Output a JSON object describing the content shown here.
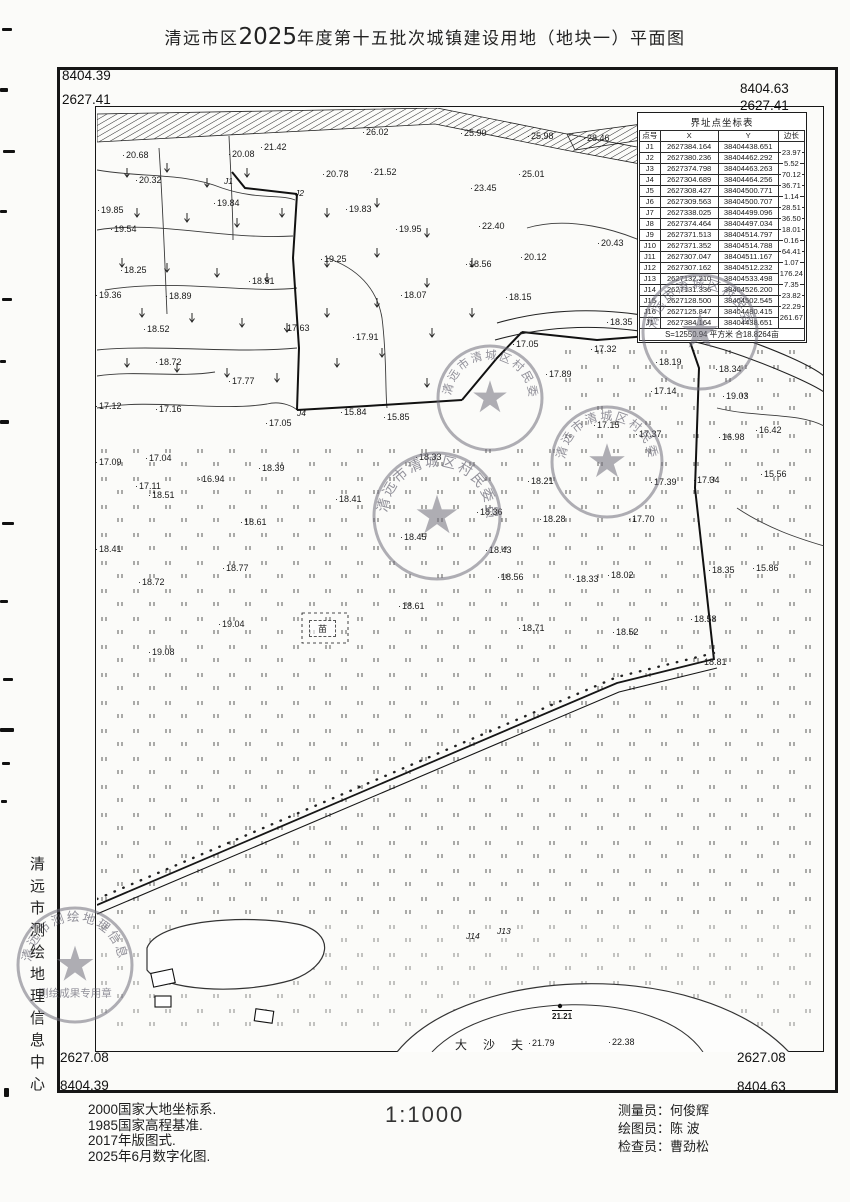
{
  "title": {
    "pre": "清远市区",
    "year": "2025",
    "post": "年度第十五批次城镇建设用地（地块一）平面图"
  },
  "frame": {
    "top_left_x": "8404.39",
    "top_left_y": "2627.41",
    "top_right_x": "8404.63",
    "top_right_y": "2627.41",
    "bottom_left_y": "2627.08",
    "bottom_left_x": "8404.39",
    "bottom_right_y": "2627.08",
    "bottom_right_x": "8404.63"
  },
  "coord_table": {
    "title": "界址点坐标表",
    "headers": [
      "点号",
      "X",
      "Y",
      "边长"
    ],
    "rows": [
      {
        "id": "J1",
        "x": "2627384.164",
        "y": "38404438.651",
        "d": ""
      },
      {
        "id": "J2",
        "x": "2627380.236",
        "y": "38404462.292",
        "d": "23.97"
      },
      {
        "id": "J3",
        "x": "2627374.798",
        "y": "38404463.263",
        "d": "5.52"
      },
      {
        "id": "J4",
        "x": "2627304.689",
        "y": "38404464.256",
        "d": "70.12"
      },
      {
        "id": "J5",
        "x": "2627308.427",
        "y": "38404500.771",
        "d": "36.71"
      },
      {
        "id": "J6",
        "x": "2627309.563",
        "y": "38404500.707",
        "d": "1.14"
      },
      {
        "id": "J7",
        "x": "2627338.025",
        "y": "38404499.096",
        "d": "28.51"
      },
      {
        "id": "J8",
        "x": "2627374.464",
        "y": "38404497.034",
        "d": "36.50"
      },
      {
        "id": "J9",
        "x": "2627371.513",
        "y": "38404514.797",
        "d": "18.01"
      },
      {
        "id": "J10",
        "x": "2627371.352",
        "y": "38404514.788",
        "d": "0.16"
      },
      {
        "id": "J11",
        "x": "2627307.047",
        "y": "38404511.167",
        "d": "64.41"
      },
      {
        "id": "J12",
        "x": "2627307.162",
        "y": "38404512.232",
        "d": "1.07"
      },
      {
        "id": "J13",
        "x": "2627132.210",
        "y": "38404533.498",
        "d": "176.24"
      },
      {
        "id": "J14",
        "x": "2627131.336",
        "y": "38404526.200",
        "d": "7.35"
      },
      {
        "id": "J15",
        "x": "2627128.500",
        "y": "38404502.545",
        "d": "23.82"
      },
      {
        "id": "J16",
        "x": "2627125.847",
        "y": "38404480.415",
        "d": "22.29"
      },
      {
        "id": "J1",
        "x": "2627384.164",
        "y": "38404438.651",
        "d": "261.67"
      }
    ],
    "summary": "S=12550.94 平方米 合18.8264亩"
  },
  "map": {
    "cement_label": "水泥",
    "dashafu_label": "大沙夫",
    "seedling_label": "苗",
    "control_point": {
      "x": 463,
      "y": 901,
      "label": "21.21"
    },
    "point_labels": [
      {
        "id": "J1",
        "x": 127,
        "y": 68
      },
      {
        "id": "J2",
        "x": 198,
        "y": 80
      },
      {
        "id": "J4",
        "x": 200,
        "y": 300
      },
      {
        "id": "J14",
        "x": 369,
        "y": 823
      },
      {
        "id": "J13",
        "x": 400,
        "y": 818
      }
    ],
    "elevations": [
      [
        27,
        47,
        "20.68"
      ],
      [
        133,
        46,
        "20.08"
      ],
      [
        165,
        39,
        "21.42"
      ],
      [
        267,
        24,
        "26.02"
      ],
      [
        365,
        25,
        "25.90"
      ],
      [
        432,
        28,
        "25.98"
      ],
      [
        488,
        30,
        "28.46"
      ],
      [
        40,
        72,
        "20.32"
      ],
      [
        227,
        66,
        "20.78"
      ],
      [
        275,
        64,
        "21.52"
      ],
      [
        423,
        66,
        "25.01"
      ],
      [
        375,
        80,
        "23.45"
      ],
      [
        2,
        102,
        "19.85"
      ],
      [
        118,
        95,
        "19.84"
      ],
      [
        250,
        101,
        "19.83"
      ],
      [
        300,
        121,
        "19.95"
      ],
      [
        383,
        118,
        "22.40"
      ],
      [
        502,
        135,
        "20.43"
      ],
      [
        15,
        121,
        "19.54"
      ],
      [
        225,
        151,
        "19.25"
      ],
      [
        370,
        156,
        "18.56"
      ],
      [
        425,
        149,
        "20.12"
      ],
      [
        25,
        162,
        "18.25"
      ],
      [
        153,
        173,
        "18.51"
      ],
      [
        305,
        187,
        "18.07"
      ],
      [
        410,
        189,
        "18.15"
      ],
      [
        511,
        214,
        "18.35"
      ],
      [
        0,
        187,
        "19.36"
      ],
      [
        70,
        188,
        "18.89"
      ],
      [
        48,
        221,
        "18.52"
      ],
      [
        188,
        220,
        "17.63"
      ],
      [
        257,
        229,
        "17.91"
      ],
      [
        417,
        236,
        "17.05"
      ],
      [
        495,
        241,
        "17.32"
      ],
      [
        60,
        254,
        "18.72"
      ],
      [
        133,
        273,
        "17.77"
      ],
      [
        450,
        266,
        "17.89"
      ],
      [
        560,
        254,
        "18.19"
      ],
      [
        620,
        261,
        "18.34"
      ],
      [
        555,
        283,
        "17.14"
      ],
      [
        627,
        288,
        "19.03"
      ],
      [
        0,
        298,
        "17.12"
      ],
      [
        60,
        301,
        "17.16"
      ],
      [
        170,
        315,
        "17.05"
      ],
      [
        245,
        304,
        "15.84"
      ],
      [
        288,
        309,
        "15.85"
      ],
      [
        320,
        349,
        "18.33"
      ],
      [
        498,
        317,
        "17.15"
      ],
      [
        540,
        326,
        "17.37"
      ],
      [
        623,
        329,
        "16.98"
      ],
      [
        660,
        322,
        "16.42"
      ],
      [
        0,
        354,
        "17.09"
      ],
      [
        50,
        350,
        "17.04"
      ],
      [
        103,
        371,
        "16.94"
      ],
      [
        163,
        360,
        "18.39"
      ],
      [
        432,
        373,
        "18.21"
      ],
      [
        555,
        374,
        "17.39"
      ],
      [
        598,
        372,
        "17.34"
      ],
      [
        665,
        366,
        "15.56"
      ],
      [
        40,
        378,
        "17.11"
      ],
      [
        53,
        387,
        "18.51"
      ],
      [
        240,
        391,
        "18.41"
      ],
      [
        145,
        414,
        "18.61"
      ],
      [
        305,
        429,
        "18.45"
      ],
      [
        381,
        404,
        "18.36"
      ],
      [
        444,
        411,
        "18.28"
      ],
      [
        533,
        411,
        "17.70"
      ],
      [
        0,
        441,
        "18.41"
      ],
      [
        127,
        460,
        "18.77"
      ],
      [
        43,
        474,
        "18.72"
      ],
      [
        390,
        442,
        "18.43"
      ],
      [
        402,
        469,
        "18.56"
      ],
      [
        477,
        471,
        "18.33"
      ],
      [
        512,
        467,
        "18.02"
      ],
      [
        613,
        462,
        "18.35"
      ],
      [
        657,
        460,
        "15.86"
      ],
      [
        303,
        498,
        "18.61"
      ],
      [
        123,
        516,
        "19.04"
      ],
      [
        423,
        520,
        "18.71"
      ],
      [
        517,
        524,
        "18.52"
      ],
      [
        595,
        511,
        "18.58"
      ],
      [
        53,
        544,
        "19.08"
      ],
      [
        605,
        554,
        "18.81"
      ],
      [
        433,
        935,
        "21.79"
      ],
      [
        513,
        934,
        "22.38"
      ]
    ]
  },
  "stamps": [
    {
      "x": 490,
      "y": 398,
      "r": 52,
      "ring": "清远市清城区村民委员会",
      "sub": ""
    },
    {
      "x": 607,
      "y": 462,
      "r": 55,
      "ring": "清远市清城区村民委员会",
      "sub": ""
    },
    {
      "x": 437,
      "y": 516,
      "r": 63,
      "ring": "清远市清城区村民委员会",
      "sub": ""
    },
    {
      "x": 700,
      "y": 332,
      "r": 57,
      "ring": "清远市清城区村民委员会",
      "sub": ""
    },
    {
      "x": 75,
      "y": 965,
      "r": 57,
      "ring": "清远市测绘地理信息中心",
      "sub": "测绘成果专用章"
    }
  ],
  "side_text": "清远市测绘地理信息中心",
  "footer": {
    "notes": [
      "2000国家大地坐标系.",
      "1985国家高程基准.",
      "2017年版图式.",
      "2025年6月数字化图."
    ],
    "scale": "1:1000",
    "credits": [
      "测量员：何俊辉",
      "绘图员：陈  波",
      "检查员：曹劲松"
    ]
  }
}
